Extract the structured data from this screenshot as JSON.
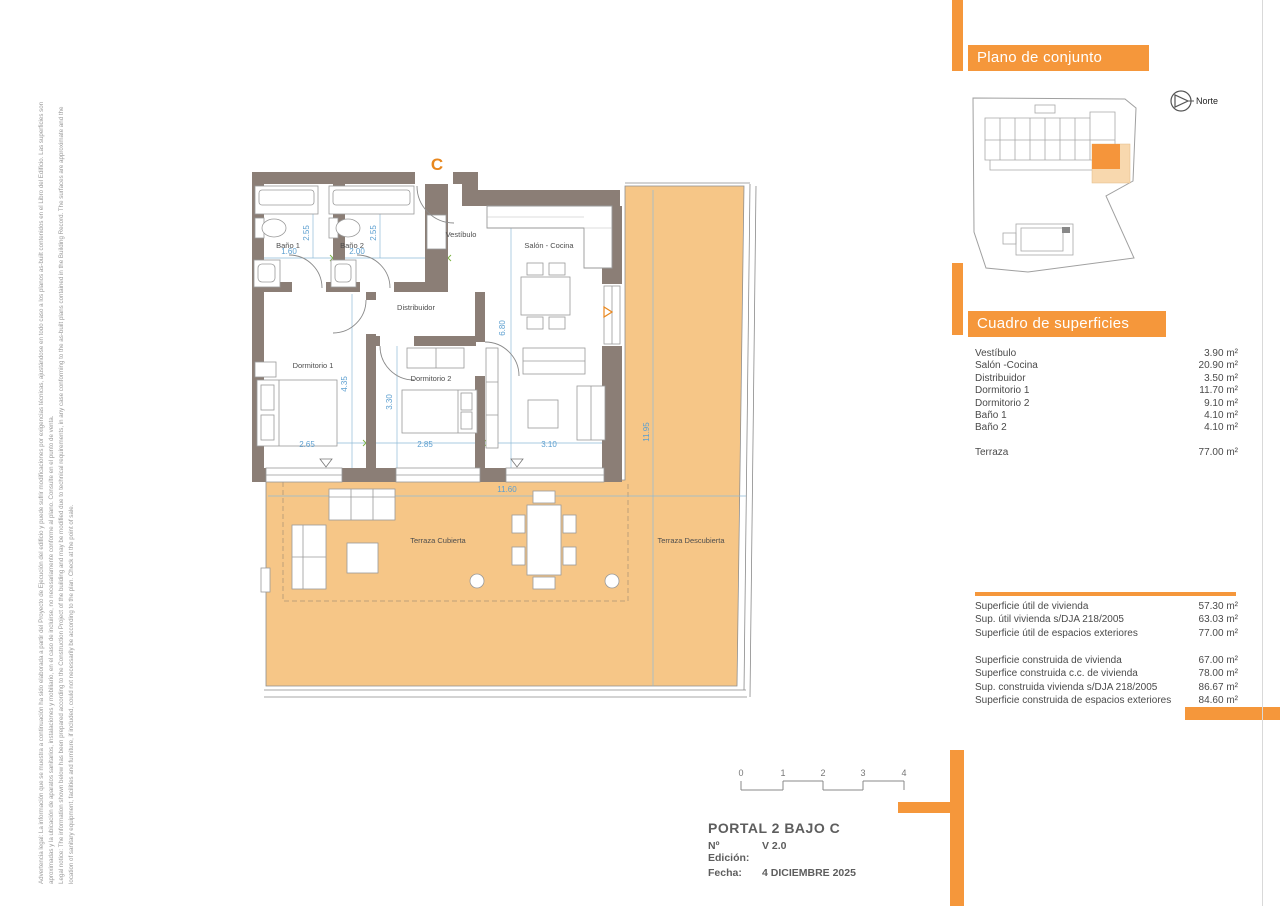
{
  "colors": {
    "accent": "#F5973B",
    "terrace_fill": "#F6C687",
    "wall": "#8B7E76",
    "dimension_blue": "#5C9FD0",
    "site_highlight": "#F5953B",
    "site_highlight_light": "#F8D8AE"
  },
  "disclaimer": {
    "lines": [
      "Advertencia legal: La información que se muestra a continuación ha sido elaborada a partir del Proyecto de Ejecución del edificio y puede sufrir modificaciones por exigencias técnicas, ajustándose en todo caso a los planos as-built contenidos en el Libro del Edificio. Las superficies son",
      "aproximadas y la ubicación de aparatos sanitarios, instalaciones y mobiliario, en el caso de incluirse, no necesariamente conforme al plano. Consulte en el punto de venta.",
      "Legal notice: The information shown below has been prepared according to the Construction Project of the building and may be modified due to technical requirements, in any case conforming to the as-built plans contained in the Building Record. The surfaces are approximate and the",
      "location of sanitary equipment, facilities and furniture, if included, could not necessarily be according to the plan. Check at the point of sale."
    ]
  },
  "site_panel": {
    "title": "Plano de conjunto",
    "north_label": "Norte"
  },
  "floor_plan": {
    "unit_label": "C",
    "labels": {
      "bano1": "Baño 1",
      "bano2": "Baño 2",
      "vestibulo": "Vestíbulo",
      "salon": "Salón - Cocina",
      "distribuidor": "Distribuidor",
      "dormitorio1": "Dormitorio 1",
      "dormitorio2": "Dormitorio 2",
      "terraza_cubierta": "Terraza Cubierta",
      "terraza_descubierta": "Terraza Descubierta"
    },
    "dims": {
      "bano1_w": "1.60",
      "bano2_w": "2.00",
      "bano1_h": "2.55",
      "bano2_h": "2.55",
      "dorm1_h": "4.35",
      "dorm2_h": "3.30",
      "salon_h": "6.80",
      "dorm1_w": "2.65",
      "dorm2_w": "2.85",
      "salon_w": "3.10",
      "terrace_w": "11.60",
      "terrace_h": "11.95"
    }
  },
  "surfaces_panel": {
    "title": "Cuadro de superficies",
    "rows": [
      {
        "label": "Vestíbulo",
        "value": "3.90 m²"
      },
      {
        "label": "Salón -Cocina",
        "value": "20.90 m²"
      },
      {
        "label": "Distribuidor",
        "value": "3.50 m²"
      },
      {
        "label": "Dormitorio 1",
        "value": "11.70 m²"
      },
      {
        "label": "Dormitorio 2",
        "value": "9.10 m²"
      },
      {
        "label": "Baño 1",
        "value": "4.10 m²"
      },
      {
        "label": "Baño 2",
        "value": "4.10 m²"
      }
    ],
    "terraza_row": {
      "label": "Terraza",
      "value": "77.00 m²"
    }
  },
  "summary_panel": {
    "group1": [
      {
        "label": "Superficie útil de vivienda",
        "value": "57.30 m²"
      },
      {
        "label": "Sup. útil vivienda s/DJA 218/2005",
        "value": "63.03 m²"
      },
      {
        "label": "Superficie útil de espacios exteriores",
        "value": "77.00 m²"
      }
    ],
    "group2": [
      {
        "label": "Superficie construida de vivienda",
        "value": "67.00 m²"
      },
      {
        "label": "Superfice construida c.c. de vivienda",
        "value": "78.00 m²"
      },
      {
        "label": "Sup. construida vivienda s/DJA 218/2005",
        "value": "86.67 m²"
      },
      {
        "label": "Superficie construida de espacios exteriores",
        "value": "84.60 m²"
      }
    ]
  },
  "scale_bar": {
    "ticks": [
      "0",
      "1",
      "2",
      "3",
      "4"
    ]
  },
  "title_block": {
    "title": "PORTAL 2  BAJO C",
    "edition_label": "Nº Edición:",
    "edition_value": "V 2.0",
    "date_label": "Fecha:",
    "date_value": "4 DICIEMBRE 2025"
  }
}
